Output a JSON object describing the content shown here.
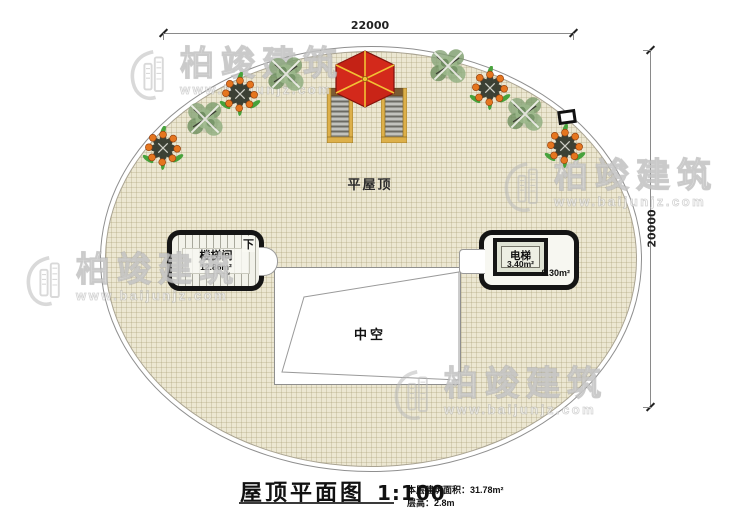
{
  "dimensions": {
    "top": "22000",
    "right": "20000"
  },
  "roof": {
    "label": "平屋顶"
  },
  "stair_room": {
    "name": "楼梯间",
    "area": "12.86m²",
    "direction": "下",
    "arrow": "↘"
  },
  "elevator": {
    "name": "电梯",
    "shaft_area": "3.40m²",
    "room_area": "8.30m²"
  },
  "void": {
    "label": "中空"
  },
  "title_block": {
    "title": "屋顶平面图",
    "scale": "1:100",
    "area_label": "本层建筑面积：",
    "area_value": "31.78m²",
    "height_label": "层高：",
    "height_value": "2.8m"
  },
  "watermark": {
    "name": "柏竣建筑",
    "url": "www.baijunjz.com"
  },
  "icons": {
    "umbrella-icon": "red hexagonal parasol (plan view)",
    "stairs-icon": "wooden outdoor stair flight",
    "tree-icon": "green shrub (plan view)",
    "fruit-plant-icon": "orange-fruit shrub (plan view)",
    "logo-building-icon": "watermark building logo",
    "roof-vent-icon": "small square roof symbol"
  }
}
